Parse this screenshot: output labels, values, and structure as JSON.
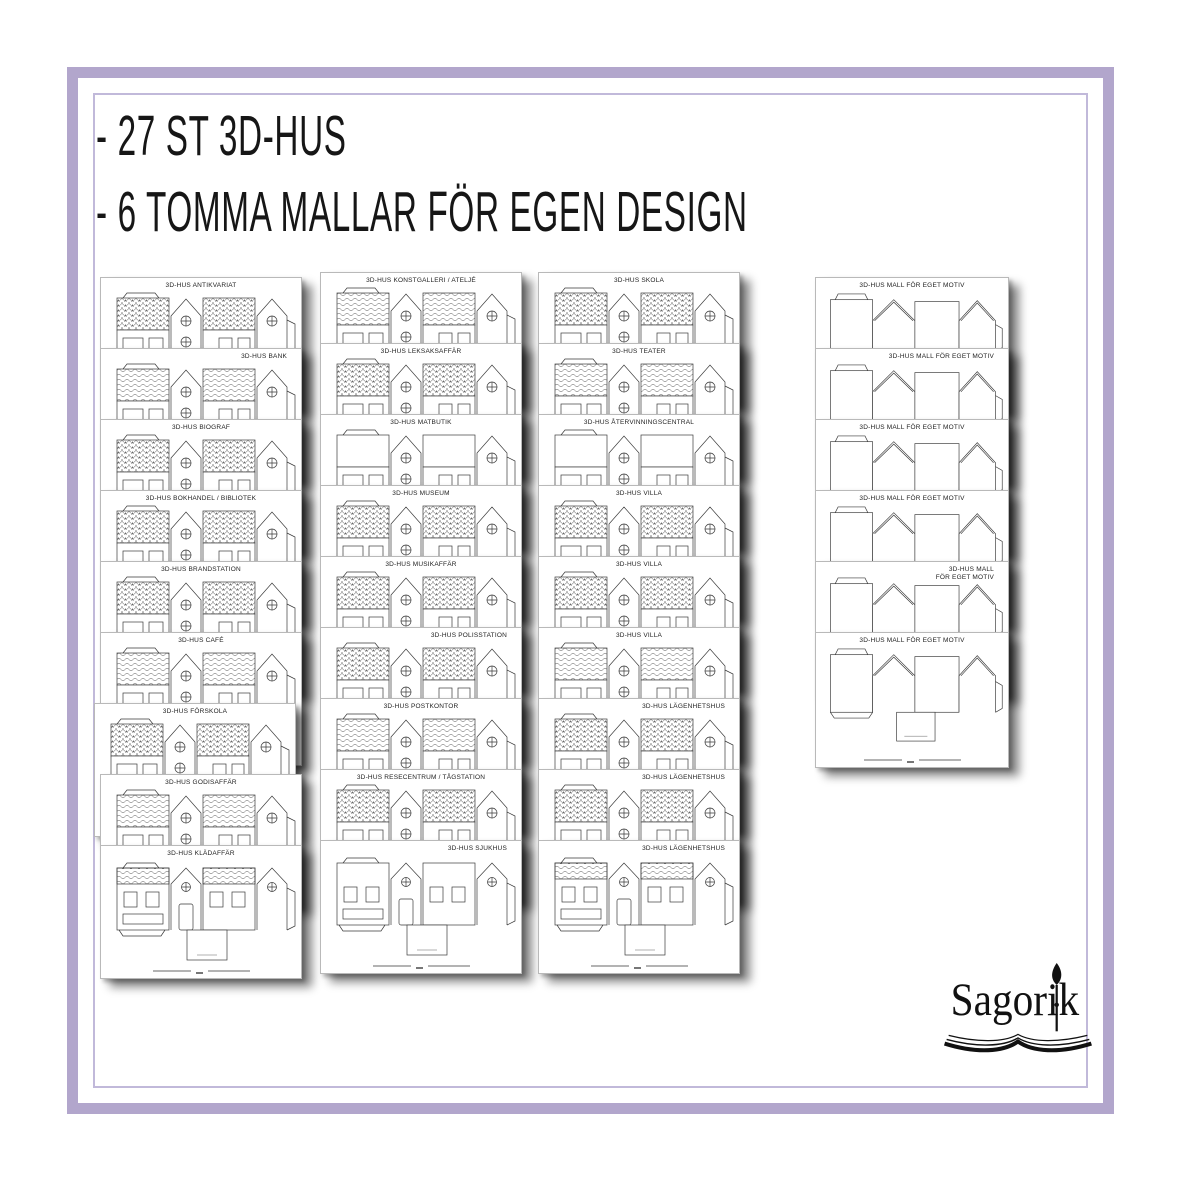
{
  "header": {
    "lines": [
      "- 27 ST 3D-HUS",
      "- 6 TOMMA MALLAR FÖR EGEN DESIGN"
    ]
  },
  "colors": {
    "frame_outer": "#b2a6cc",
    "frame_inner": "#c1b9da",
    "ink": "#161616",
    "paper": "#ffffff"
  },
  "columns": [
    {
      "sheets": [
        {
          "title": "3D-HUS ANTIKVARIAT",
          "roof": "scallop",
          "align": "center"
        },
        {
          "title": "3D-HUS BANK",
          "roof": "wave",
          "align": "right"
        },
        {
          "title": "3D-HUS BIOGRAF",
          "roof": "scallop",
          "align": "center"
        },
        {
          "title": "3D-HUS BOKHANDEL / BIBLIOTEK",
          "roof": "scallop",
          "align": "center"
        },
        {
          "title": "3D-HUS BRANDSTATION",
          "roof": "scallop",
          "align": "center"
        },
        {
          "title": "3D-HUS CAFÉ",
          "roof": "wave",
          "align": "center"
        },
        {
          "title": "3D-HUS FÖRSKOLA",
          "roof": "scallop",
          "align": "center"
        },
        {
          "title": "3D-HUS GODISAFFÄR",
          "roof": "wave",
          "align": "center"
        },
        {
          "title": "3D-HUS KLÄDAFFÄR",
          "roof": "wave",
          "align": "center"
        }
      ]
    },
    {
      "sheets": [
        {
          "title": "3D-HUS KONSTGALLERI / ATELJÉ",
          "roof": "wave",
          "align": "center"
        },
        {
          "title": "3D-HUS LEKSAKSAFFÄR",
          "roof": "scallop",
          "align": "center"
        },
        {
          "title": "3D-HUS MATBUTIK",
          "roof": "plain",
          "align": "center"
        },
        {
          "title": "3D-HUS MUSEUM",
          "roof": "scallop",
          "align": "center"
        },
        {
          "title": "3D-HUS MUSIKAFFÄR",
          "roof": "scallop",
          "align": "center"
        },
        {
          "title": "3D-HUS POLISSTATION",
          "roof": "scallop",
          "align": "right"
        },
        {
          "title": "3D-HUS POSTKONTOR",
          "roof": "wave",
          "align": "center"
        },
        {
          "title": "3D-HUS RESECENTRUM / TÅGSTATION",
          "roof": "scallop",
          "align": "center"
        },
        {
          "title": "3D-HUS SJUKHUS",
          "roof": "plain",
          "align": "right"
        }
      ]
    },
    {
      "sheets": [
        {
          "title": "3D-HUS SKOLA",
          "roof": "scallop",
          "align": "center"
        },
        {
          "title": "3D-HUS TEATER",
          "roof": "wave",
          "align": "center"
        },
        {
          "title": "3D-HUS ÅTERVINNINGSCENTRAL",
          "roof": "plain",
          "align": "center"
        },
        {
          "title": "3D-HUS VILLA",
          "roof": "scallop",
          "align": "center"
        },
        {
          "title": "3D-HUS VILLA",
          "roof": "scallop",
          "align": "center"
        },
        {
          "title": "3D-HUS VILLA",
          "roof": "wave",
          "align": "center"
        },
        {
          "title": "3D-HUS LÄGENHETSHUS",
          "roof": "scallop",
          "align": "right"
        },
        {
          "title": "3D-HUS LÄGENHETSHUS",
          "roof": "scallop",
          "align": "right"
        },
        {
          "title": "3D-HUS LÄGENHETSHUS",
          "roof": "wave",
          "align": "right"
        }
      ]
    },
    {
      "sheets": [
        {
          "title": "3D-HUS MALL FÖR EGET MOTIV",
          "roof": "blank",
          "align": "center"
        },
        {
          "title": "3D-HUS MALL FÖR EGET MOTIV",
          "roof": "blank",
          "align": "right"
        },
        {
          "title": "3D-HUS MALL FÖR EGET MOTIV",
          "roof": "blank",
          "align": "center"
        },
        {
          "title": "3D-HUS MALL FÖR EGET MOTIV",
          "roof": "blank",
          "align": "center"
        },
        {
          "title": "3D-HUS MALL\nFÖR EGET MOTIV",
          "roof": "blank",
          "align": "right"
        },
        {
          "title": "3D-HUS MALL FÖR EGET MOTIV",
          "roof": "blank",
          "align": "center"
        }
      ]
    }
  ],
  "logo": {
    "text": "Sagorik",
    "icons": [
      "paintbrush-icon",
      "open-book-icon"
    ]
  }
}
